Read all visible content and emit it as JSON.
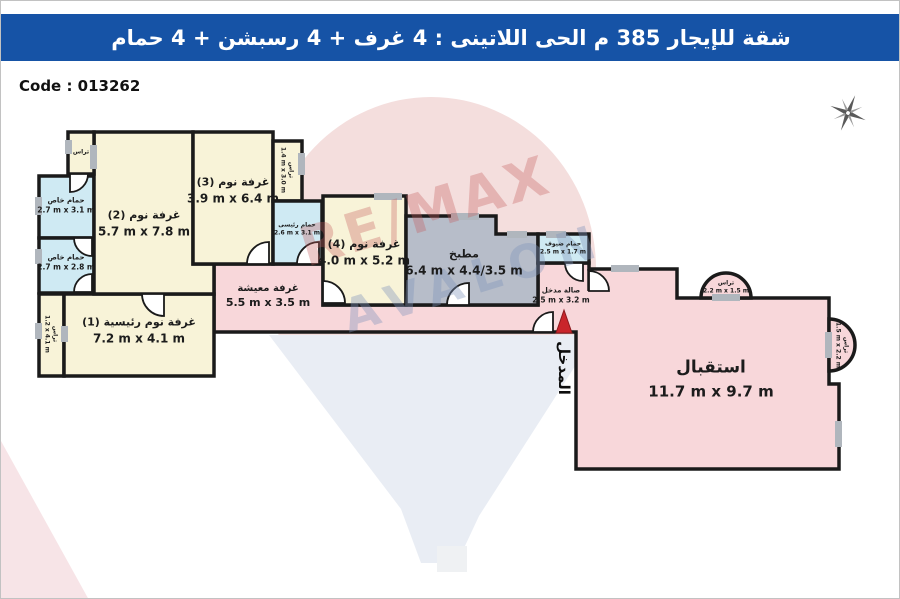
{
  "header": {
    "title": "شقة للإيجار 385 م الحى اللاتينى : 4 غرف + 4 رسبشن + 4 حمام"
  },
  "code_label": "Code : 013262",
  "watermark": {
    "line1": "RE/MAX",
    "line2": "AVALON"
  },
  "icons": {
    "compass": "compass-rose-icon",
    "entry_arrow": "entry-arrow-icon"
  },
  "colors": {
    "header_bg": "#1653a6",
    "room_cream": "#f8f3d8",
    "room_pink": "#f8d7da",
    "room_blue": "#cfeaf3",
    "kitchen_gray": "#b7bdc9",
    "wall": "#1a1a1a",
    "window_mark": "#b0b6bd",
    "entry_red": "#c9252b"
  },
  "rooms": {
    "bedroom_master": {
      "name": "غرفة نوم رئيسية (1)",
      "dims": "7.2 m x 4.1 m"
    },
    "bedroom_2": {
      "name": "غرفة نوم (2)",
      "dims": "5.7 m x 7.8 m"
    },
    "bedroom_3": {
      "name": "غرفة نوم (3)",
      "dims": "3.9 m x 6.4 m"
    },
    "bedroom_4": {
      "name": "غرفة نوم (4)",
      "dims": "4.0 m x 5.2 m"
    },
    "living": {
      "name": "غرفة معيشة",
      "dims": "5.5 m x 3.5 m"
    },
    "kitchen": {
      "name": "مطبخ",
      "dims": "6.4 m x 4.4/3.5 m"
    },
    "reception": {
      "name": "استقبال",
      "dims": "11.7 m x 9.7 m"
    },
    "bath_private_1": {
      "name": "حمام خاص",
      "dims": "2.7 m x 3.1 m"
    },
    "bath_private_2": {
      "name": "حمام خاص",
      "dims": "2.7 m x 2.8 m"
    },
    "bath_main": {
      "name": "حمام رئيسى",
      "dims": "2.6 m x 3.1 m"
    },
    "bath_guest": {
      "name": "حمام ضيوف",
      "dims": "2.5 m x 1.7 m"
    },
    "hall": {
      "name": "صالة مدخل",
      "dims": "2.5 m x 3.2 m"
    },
    "terrace_small": {
      "name": "تراس"
    },
    "terrace_b3": {
      "name": "تراس",
      "dims": "1.4 m x 3.0 m"
    },
    "terrace_b1": {
      "name": "تراس",
      "dims": "1.2 x 4.1 m"
    },
    "terrace_top": {
      "name": "تراس",
      "dims": "2.2 m x 1.5 m"
    },
    "terrace_right": {
      "name": "تراس",
      "dims": "1.5 m x 2.2 m"
    },
    "entrance": {
      "name": "المدخل"
    }
  }
}
